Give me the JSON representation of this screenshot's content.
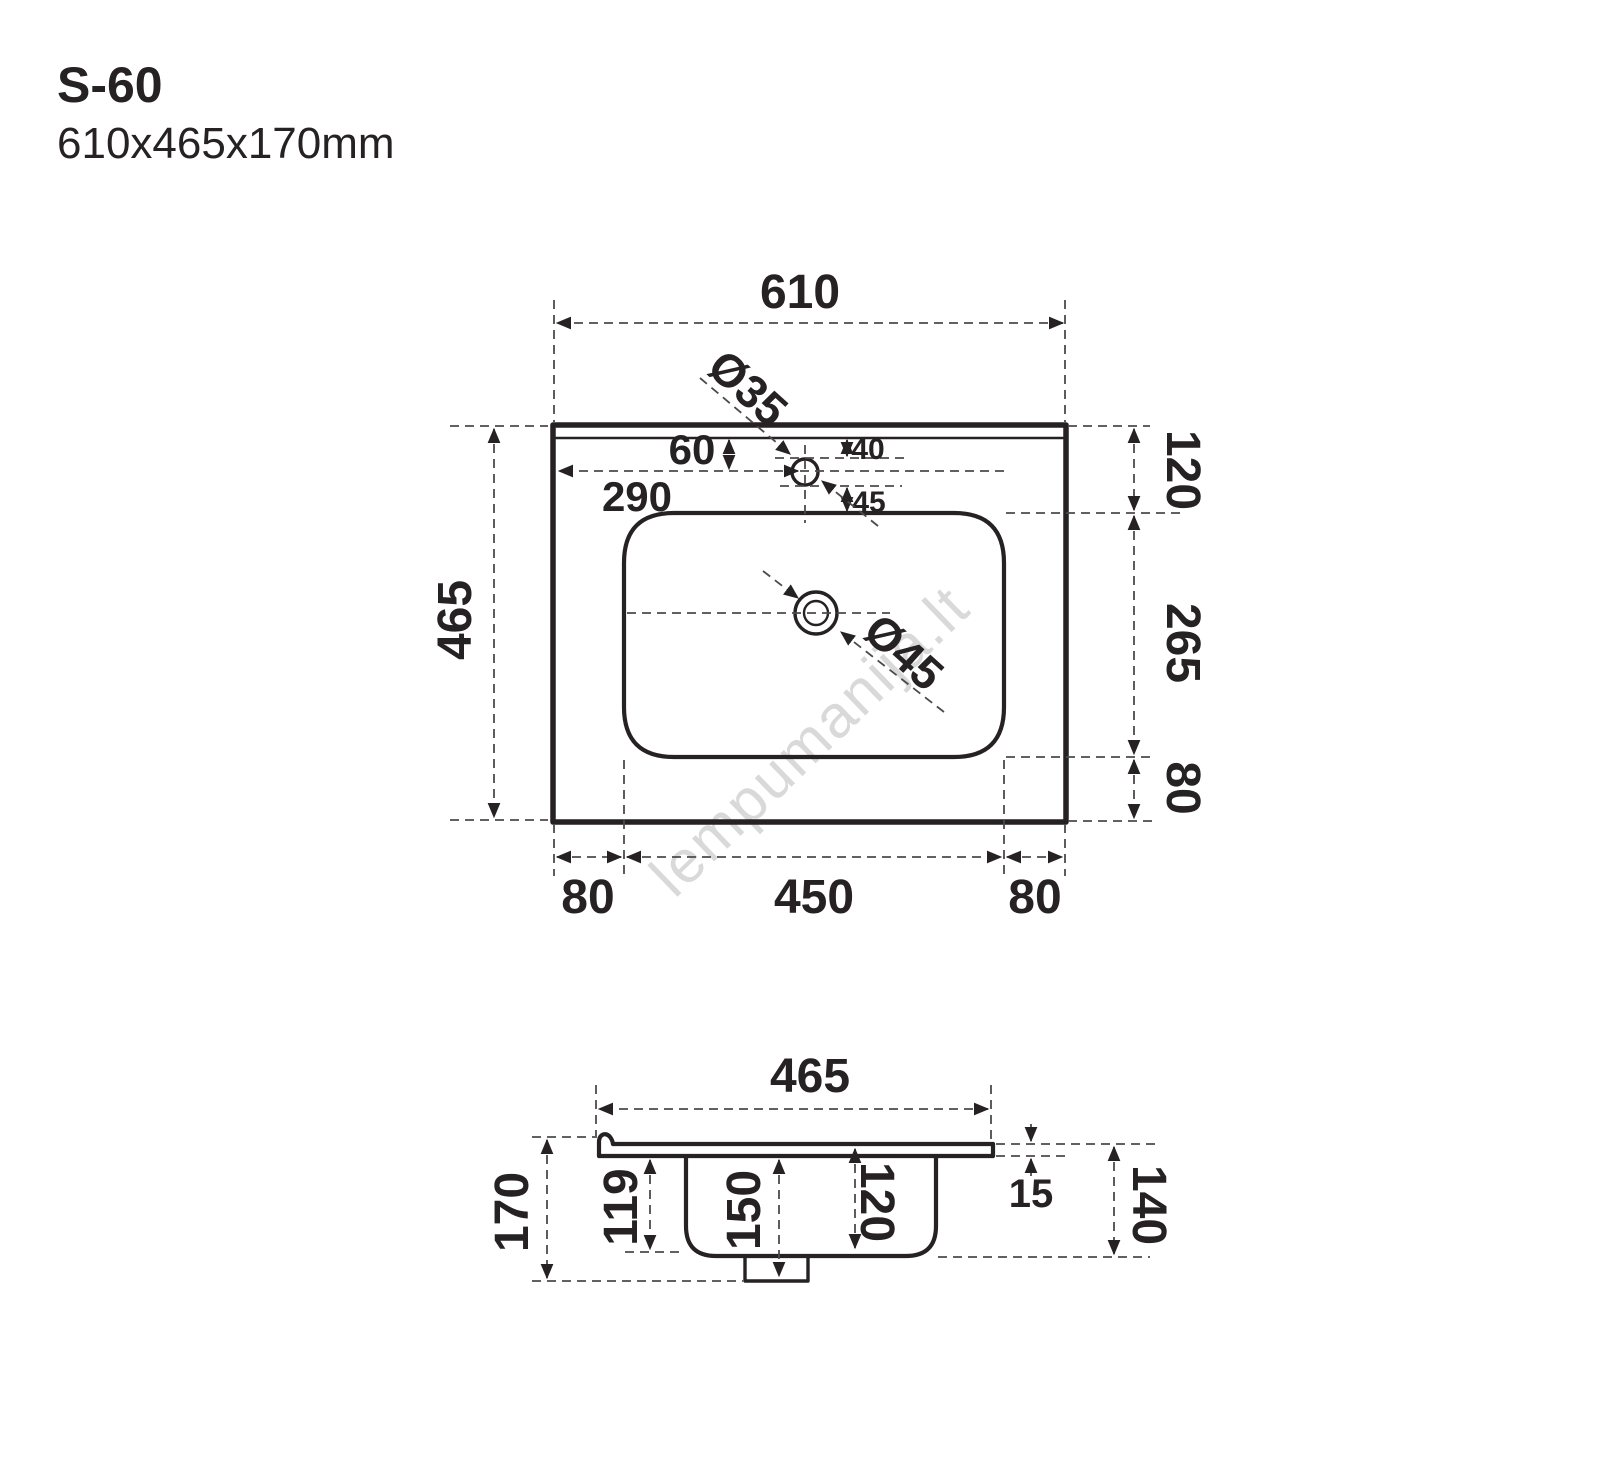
{
  "title": {
    "model": "S-60",
    "dimensions": "610x465x170mm"
  },
  "watermark": "lempumanija.lt",
  "colors": {
    "line": "#262122",
    "construction": "#4b4b4b",
    "watermark": "#d9d9d9",
    "background": "#ffffff"
  },
  "plan_view": {
    "label_width": "610",
    "label_height": "465",
    "label_faucet_diameter": "Ø35",
    "label_faucet_offset": "60",
    "label_faucet_from_left": "290",
    "label_hole_to_top": "40",
    "label_hole_to_basin": "45",
    "label_drain_diameter": "Ø45",
    "label_right_top": "120",
    "label_right_mid": "265",
    "label_right_bottom": "80",
    "label_bottom_left": "80",
    "label_bottom_center": "450",
    "label_bottom_right": "80"
  },
  "section_view": {
    "label_width": "465",
    "label_height": "170",
    "label_bowl_front_depth": "119",
    "label_total_depth": "150",
    "label_bowl_inner_depth": "120",
    "label_top_thickness": "15",
    "label_back_height": "140"
  }
}
